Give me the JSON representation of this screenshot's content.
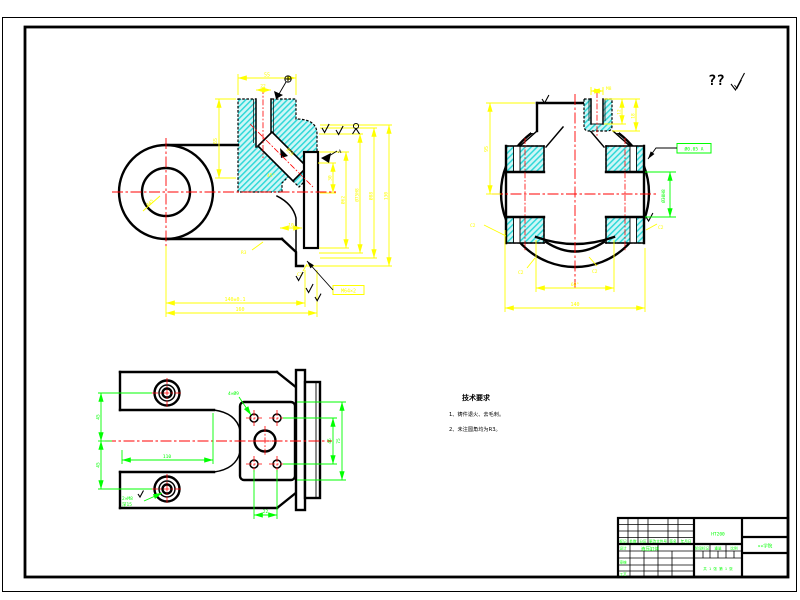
{
  "window": {
    "background": "#FFFFFF"
  },
  "colors": {
    "outline": "#000000",
    "dimension": "#FFFF00",
    "centerline": "#FF0000",
    "annotation": "#00FF00",
    "hatch_fill": "#CFF6F6",
    "hatch_line": "#2FD8D8"
  },
  "corner_mark": {
    "text": "??"
  },
  "front_view": {
    "eye_bore": "Ø45",
    "top_width": "55",
    "slot_width": "22",
    "left_height": "65",
    "port_dia": "Ø16",
    "port_angle": "45°",
    "boss_inner": "30",
    "dia_1": "Ø62",
    "dia_2": "Ø75H8",
    "dia_3": "Ø88",
    "overall_height": "130",
    "neck_len": "10",
    "len_1": "140±0.1",
    "len_2": "160",
    "thread_label": "M64×2",
    "chamfer": "C2",
    "fillet": "R3",
    "datum": "A"
  },
  "side_view": {
    "top_thread": "M8",
    "depth_1": "12",
    "depth_2": "18",
    "height": "95",
    "chamfer_left": "C2",
    "chamfer_right": "C2",
    "bore_label": "Ø30H8",
    "tolerance_frame": "Ø0.05 A",
    "dish_angle": "60°",
    "width": "140",
    "chamfer_b1": "C2",
    "chamfer_b2": "C2"
  },
  "plan_view": {
    "boss_span_upper": "45",
    "boss_span_lower": "45",
    "slot_length": "110",
    "flange_height": "75",
    "hole_span_v": "46",
    "hole_span_h": "22",
    "holes_label": "4×Ø9",
    "boss_thread_1": "2×M8",
    "boss_thread_2": "深15"
  },
  "notes": {
    "title": "技术要求",
    "item_1": "1、铸件退火、去毛刺。",
    "item_2": "2、未注圆角均为R3。"
  },
  "title_block": {
    "rev_headers": [
      "标记",
      "处数",
      "分区",
      "更改文件号",
      "签名",
      "年月日"
    ],
    "row_design": "设计",
    "row_check": "审核",
    "row_process": "工艺",
    "part_name": "液压缸体",
    "material": "HT200",
    "stage": "阶段标记",
    "weight": "重量",
    "scale": "比例",
    "sheets": "共 1 张  第 1 张",
    "company": "××学院"
  }
}
